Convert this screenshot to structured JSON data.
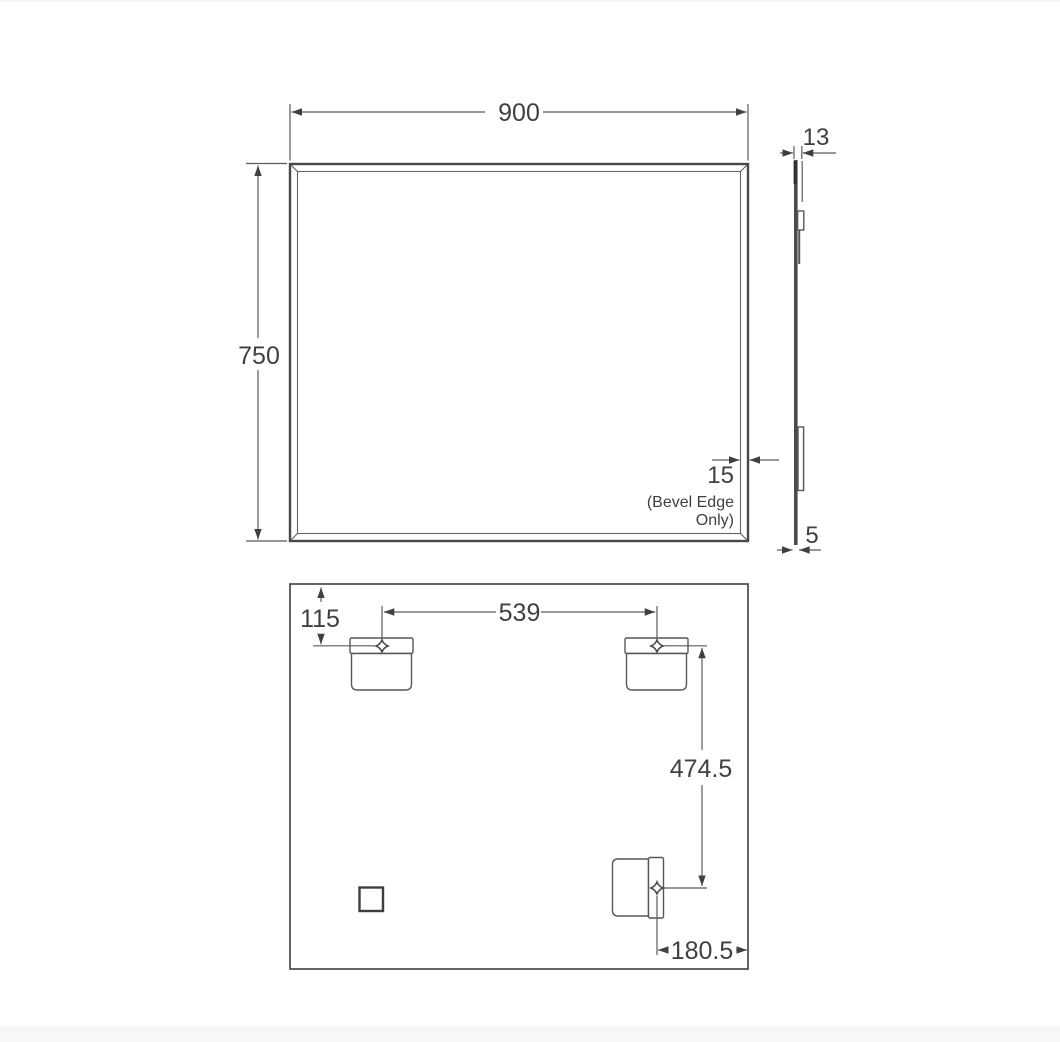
{
  "page": {
    "background": "#ffffff",
    "footer_band_color": "#f7f7f8"
  },
  "drawing": {
    "front_view": {
      "width": "900",
      "height": "750",
      "bevel_width": "15",
      "bevel_note_line1": "(Bevel Edge",
      "bevel_note_line2": "Only)"
    },
    "side_view": {
      "overall_depth": "13",
      "glass_thickness": "5"
    },
    "back_view": {
      "hanger_top_offset": "115",
      "hanger_spacing": "539",
      "hanger_vertical_offset": "474.5",
      "hanger_side_offset": "180.5"
    },
    "colors": {
      "outline": "#48494b",
      "dimension_line": "#5a5b5e",
      "text": "#3f4042"
    }
  }
}
